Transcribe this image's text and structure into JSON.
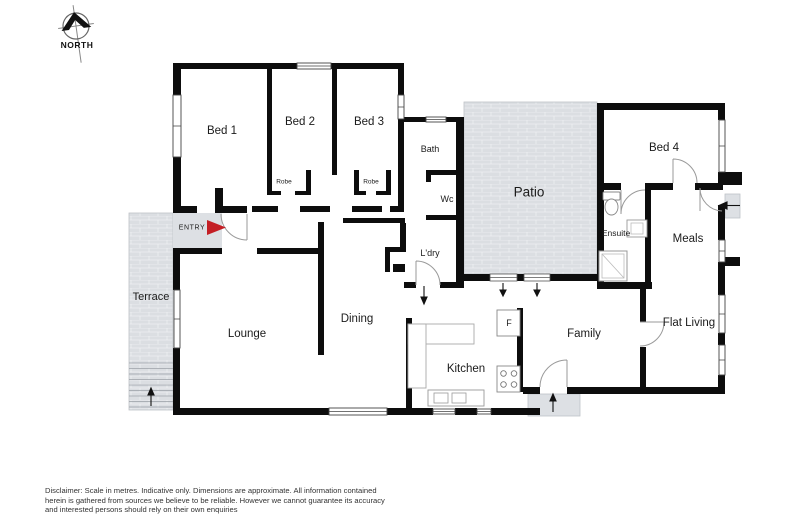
{
  "compass": {
    "label": "NORTH"
  },
  "rooms": {
    "bed1": "Bed 1",
    "bed2": "Bed 2",
    "bed3": "Bed 3",
    "bed4": "Bed 4",
    "robe_bed2": "Robe",
    "robe_bed3": "Robe",
    "bath": "Bath",
    "wc": "Wc",
    "laundry": "L'dry",
    "patio": "Patio",
    "ensuite": "Ensuite",
    "meals": "Meals",
    "terrace": "Terrace",
    "entry": "ENTRY",
    "lounge": "Lounge",
    "dining": "Dining",
    "kitchen": "Kitchen",
    "fridge": "F",
    "family": "Family",
    "flat_living": "Flat Living"
  },
  "colors": {
    "wall": "#0d0d0d",
    "paving": "#dbdee2",
    "entry_arrow": "#c41f25"
  },
  "disclaimer": {
    "line1": "Disclaimer: Scale in metres. Indicative only. Dimensions are approximate. All information contained",
    "line2": "herein is gathered from sources we believe to be reliable. However we cannot guarantee its accuracy",
    "line3": "and interested persons should rely on their own enquiries"
  }
}
